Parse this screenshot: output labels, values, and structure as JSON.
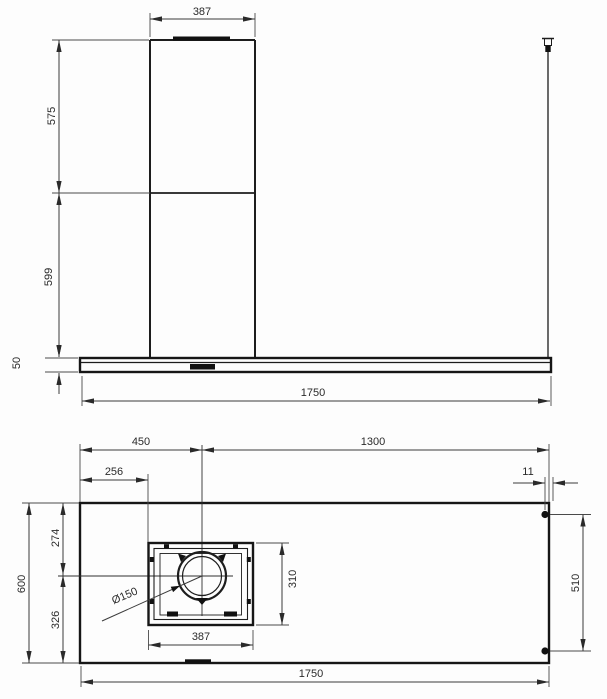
{
  "drawing": {
    "kind": "technical installation drawing",
    "line_color": "#1d1d1d",
    "front_view": {
      "duct_width": "387",
      "upper_chimney_height": "575",
      "lower_chimney_height": "599",
      "body_height": "50",
      "total_width": "1750"
    },
    "plan_view": {
      "left_to_duct_center": "450",
      "duct_center_to_right": "1300",
      "left_to_duct_box": "256",
      "mount_inset": "11",
      "front_to_duct_center": "274",
      "total_depth": "600",
      "duct_center_to_rear": "326",
      "duct_box_depth": "310",
      "duct_box_width": "387",
      "mount_span": "510",
      "total_width": "1750",
      "duct_diameter": "Ø150"
    }
  }
}
